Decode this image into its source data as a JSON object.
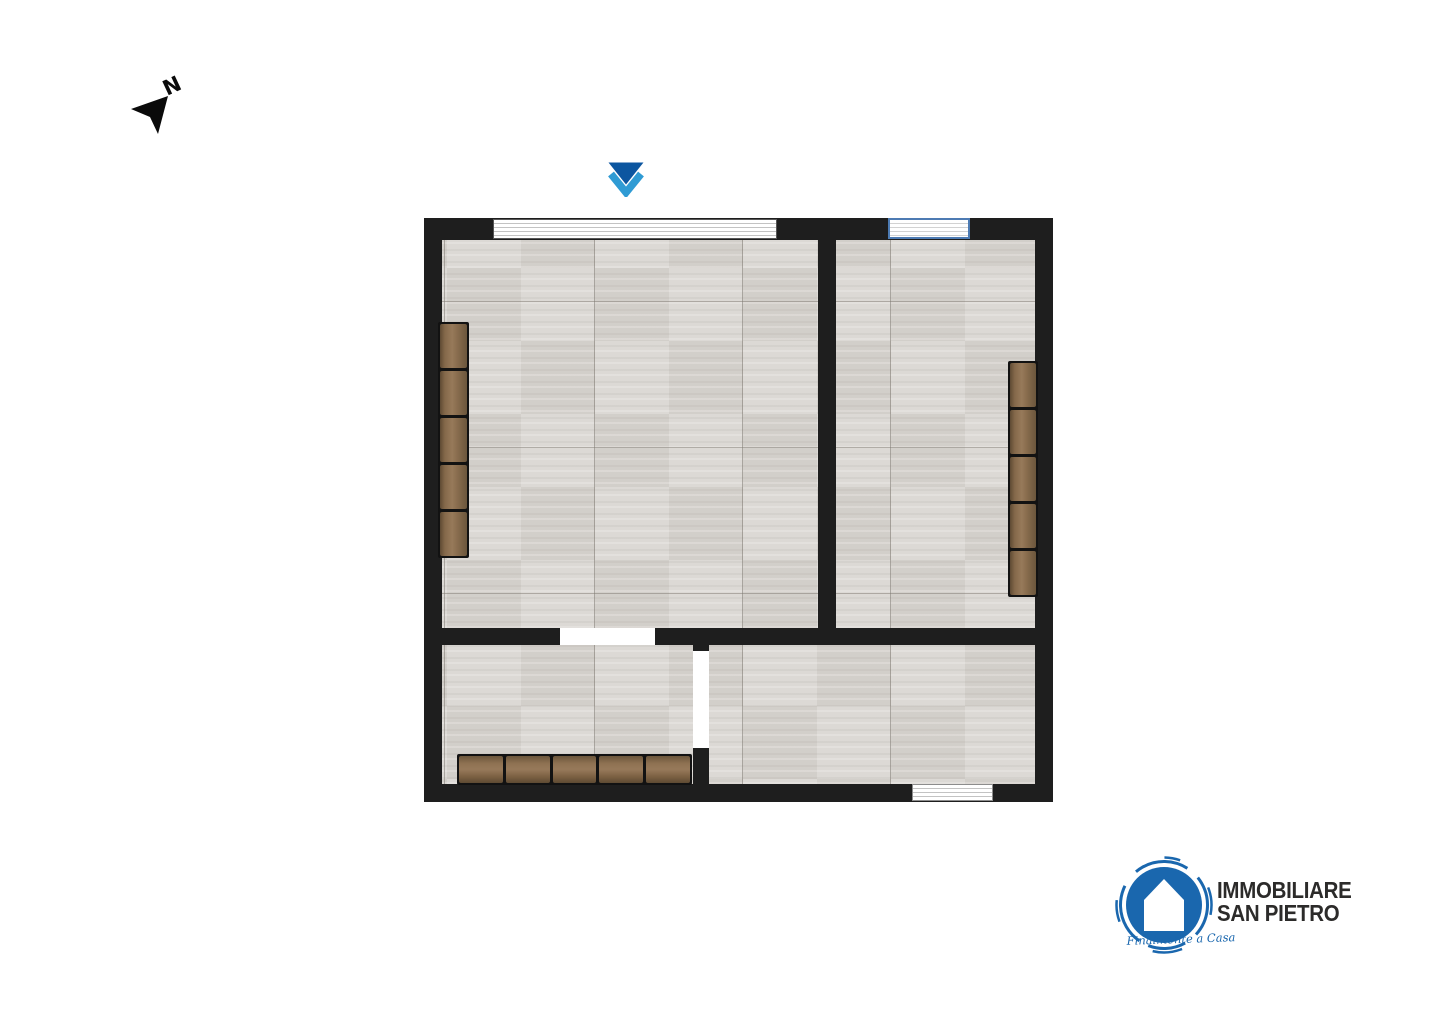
{
  "compass": {
    "label": "N",
    "color": "#0a0a0a"
  },
  "entrance": {
    "triangle_color": "#0c56a0",
    "chevron_color": "#2f9bd4"
  },
  "plan": {
    "wall_color": "#1e1e1e",
    "floor_tile_color": "#dcd9d5",
    "furniture_wood_color": "#8a6e4f",
    "window_frame_blue": "#4d7bb3",
    "rooms_count": 4,
    "windows_count": 3,
    "radiators": {
      "count": 3,
      "segments_each": 5
    },
    "door_openings_count": 2
  },
  "logo": {
    "line1": "IMMOBILIARE",
    "line2": "SAN PIETRO",
    "tagline": "Finalmente a Casa",
    "blue": "#1a67ae",
    "text_color": "#2c2b2a"
  }
}
